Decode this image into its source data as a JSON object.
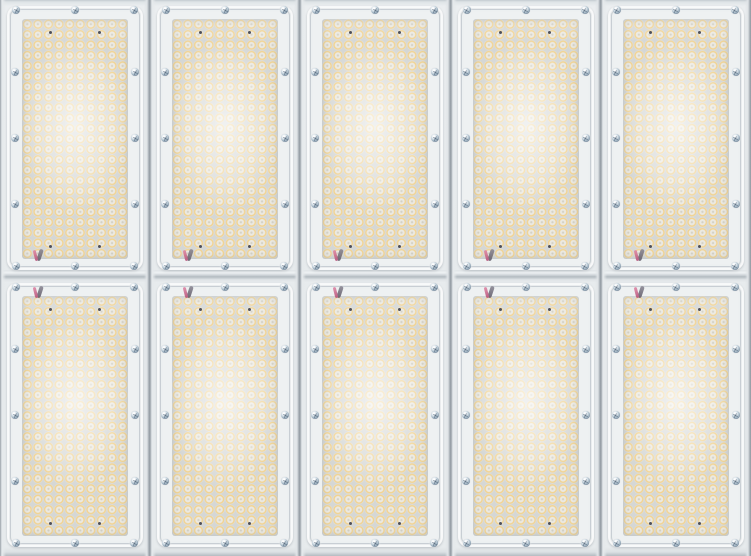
{
  "image": {
    "subject": "Close-up front view of an array of modular LED floodlight light engines",
    "grid": {
      "columns": 5,
      "panels_per_column": 2
    }
  },
  "module": {
    "led_grid": {
      "columns": 10,
      "rows": 23
    },
    "screws_per_panel": 12,
    "screw_positions": [
      [
        9,
        4
      ],
      [
        68,
        4
      ],
      [
        127,
        4
      ],
      [
        8,
        66
      ],
      [
        128,
        66
      ],
      [
        8,
        132
      ],
      [
        128,
        132
      ],
      [
        8,
        198
      ],
      [
        128,
        198
      ],
      [
        9,
        260
      ],
      [
        68,
        260
      ],
      [
        127,
        260
      ]
    ],
    "pcb_dot_positions": [
      [
        43,
        26
      ],
      [
        92,
        26
      ],
      [
        43,
        240
      ],
      [
        92,
        240
      ]
    ],
    "wire_position": {
      "top_panel": [
        27,
        242
      ],
      "bottom_panel": [
        27,
        2
      ]
    }
  },
  "colors": {
    "glass": "#eef1f2",
    "led_ring": "#f1d392",
    "led_face": "#ebe9e2",
    "led_dot": "#d5d1c3",
    "led_bg": "#d5d7d5",
    "gap_dark": "#8f979e",
    "screw_base": "#a9bcca",
    "screw_rim": "#76889a",
    "dot": "#4e505a",
    "wire_dark_a": "#8d8a96",
    "wire_dark_b": "#5f5a68",
    "wire_pink_a": "#e08aa8",
    "wire_pink_b": "#b44f78"
  }
}
